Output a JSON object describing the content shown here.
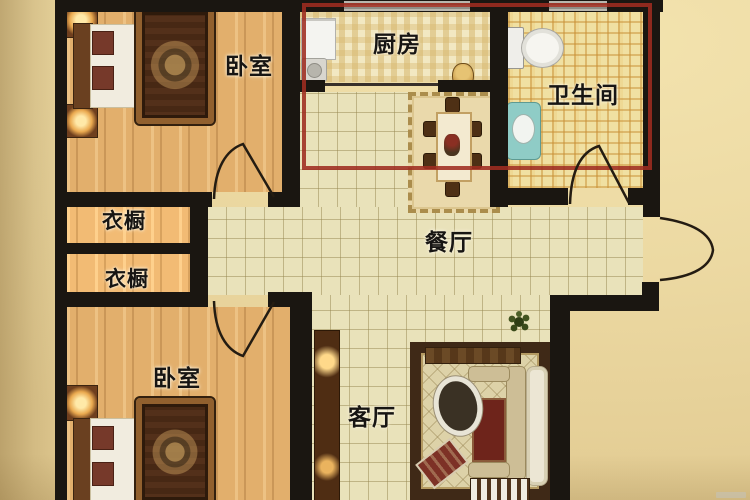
{
  "plan_title": "two-bedroom apartment floor plan",
  "rooms": {
    "bedroom_top": {
      "label": "卧室"
    },
    "kitchen": {
      "label": "厨房"
    },
    "bathroom": {
      "label": "卫生间"
    },
    "wardrobe_top": {
      "label": "衣橱"
    },
    "wardrobe_bottom": {
      "label": "衣橱"
    },
    "dining": {
      "label": "餐厅"
    },
    "bedroom_bottom": {
      "label": "卧室"
    },
    "living": {
      "label": "客厅"
    }
  },
  "annotation": {
    "shape": "red-rectangle-highlight",
    "area": "kitchen, bathroom and upper dining area",
    "color": "#9e2f23"
  },
  "colors": {
    "wall": "#1a1611",
    "background": "#ecd9a2",
    "wood_floor": "#e2af6c",
    "tile_floor": "#e9e2ba",
    "kitchen_tile": "#f2e8c2",
    "bathroom_tile": "#f0e0a2"
  },
  "icons": [
    "double-bed",
    "nightstand-lamp",
    "dining-table-with-chairs",
    "toilet",
    "wash-basin",
    "fridge",
    "sofa-set",
    "oval-coffee-table",
    "tv-cabinet",
    "potted-plant",
    "door-swing-arc",
    "window"
  ]
}
